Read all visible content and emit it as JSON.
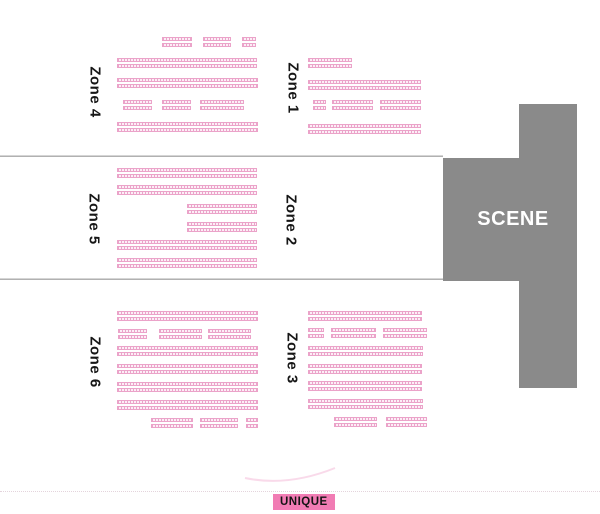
{
  "colors": {
    "seat_border": "#eba3c9",
    "seat_fill": "#fceef6",
    "scene_gray": "#8a8a8a",
    "unique_bg": "#f17cb4",
    "arc_pink": "#f4bcd8"
  },
  "scene": {
    "label": "SCENE"
  },
  "legend": {
    "unique_label": "UNIQUE"
  },
  "dividers": [
    {
      "x": 0,
      "y": 155,
      "w": 443
    },
    {
      "x": 0,
      "y": 278,
      "w": 443
    }
  ],
  "zones": [
    {
      "id": "zone-4",
      "label": "Zone 4",
      "label_x": 95,
      "label_y": 92,
      "rows": [
        {
          "y": 37,
          "segments": [
            [
              162,
              30
            ],
            [
              203,
              28
            ],
            [
              242,
              14
            ]
          ]
        },
        {
          "y": 58,
          "segments": [
            [
              117,
              140
            ]
          ]
        },
        {
          "y": 78,
          "segments": [
            [
              117,
              141
            ]
          ]
        },
        {
          "y": 100,
          "segments": [
            [
              123,
              29
            ],
            [
              162,
              29
            ],
            [
              200,
              44
            ]
          ]
        },
        {
          "y": 122,
          "segments": [
            [
              117,
              141
            ]
          ]
        }
      ]
    },
    {
      "id": "zone-1",
      "label": "Zone 1",
      "label_x": 293,
      "label_y": 88,
      "rows": [
        {
          "y": 58,
          "segments": [
            [
              308,
              44
            ]
          ]
        },
        {
          "y": 80,
          "segments": [
            [
              308,
              113
            ]
          ]
        },
        {
          "y": 100,
          "segments": [
            [
              313,
              13
            ],
            [
              332,
              41
            ],
            [
              380,
              41
            ]
          ]
        },
        {
          "y": 124,
          "segments": [
            [
              308,
              113
            ]
          ]
        }
      ]
    },
    {
      "id": "zone-5",
      "label": "Zone 5",
      "label_x": 94,
      "label_y": 219,
      "rows": [
        {
          "y": 168,
          "segments": [
            [
              117,
              140
            ]
          ]
        },
        {
          "y": 185,
          "segments": [
            [
              117,
              140
            ]
          ]
        },
        {
          "y": 204,
          "segments": [
            [
              187,
              70
            ]
          ]
        },
        {
          "y": 222,
          "segments": [
            [
              187,
              70
            ]
          ]
        },
        {
          "y": 240,
          "segments": [
            [
              117,
              140
            ]
          ]
        },
        {
          "y": 258,
          "segments": [
            [
              117,
              140
            ]
          ]
        }
      ]
    },
    {
      "id": "zone-2",
      "label": "Zone 2",
      "label_x": 291,
      "label_y": 220,
      "rows": []
    },
    {
      "id": "zone-6",
      "label": "Zone 6",
      "label_x": 95,
      "label_y": 362,
      "rows": [
        {
          "y": 311,
          "segments": [
            [
              117,
              141
            ]
          ]
        },
        {
          "y": 329,
          "segments": [
            [
              118,
              29
            ],
            [
              159,
              43
            ],
            [
              208,
              43
            ]
          ]
        },
        {
          "y": 346,
          "segments": [
            [
              117,
              141
            ]
          ]
        },
        {
          "y": 364,
          "segments": [
            [
              117,
              141
            ]
          ]
        },
        {
          "y": 382,
          "segments": [
            [
              117,
              141
            ]
          ]
        },
        {
          "y": 400,
          "segments": [
            [
              117,
              141
            ]
          ]
        },
        {
          "y": 418,
          "segments": [
            [
              151,
              42
            ],
            [
              200,
              38
            ],
            [
              246,
              12
            ]
          ]
        }
      ]
    },
    {
      "id": "zone-3",
      "label": "Zone 3",
      "label_x": 292,
      "label_y": 358,
      "rows": [
        {
          "y": 311,
          "segments": [
            [
              308,
              114
            ]
          ]
        },
        {
          "y": 328,
          "segments": [
            [
              308,
              16
            ],
            [
              331,
              45
            ],
            [
              383,
              44
            ]
          ]
        },
        {
          "y": 346,
          "segments": [
            [
              308,
              115
            ]
          ]
        },
        {
          "y": 364,
          "segments": [
            [
              308,
              114
            ]
          ]
        },
        {
          "y": 381,
          "segments": [
            [
              308,
              114
            ]
          ]
        },
        {
          "y": 399,
          "segments": [
            [
              308,
              115
            ]
          ]
        },
        {
          "y": 417,
          "segments": [
            [
              334,
              43
            ],
            [
              386,
              41
            ]
          ]
        }
      ]
    }
  ]
}
